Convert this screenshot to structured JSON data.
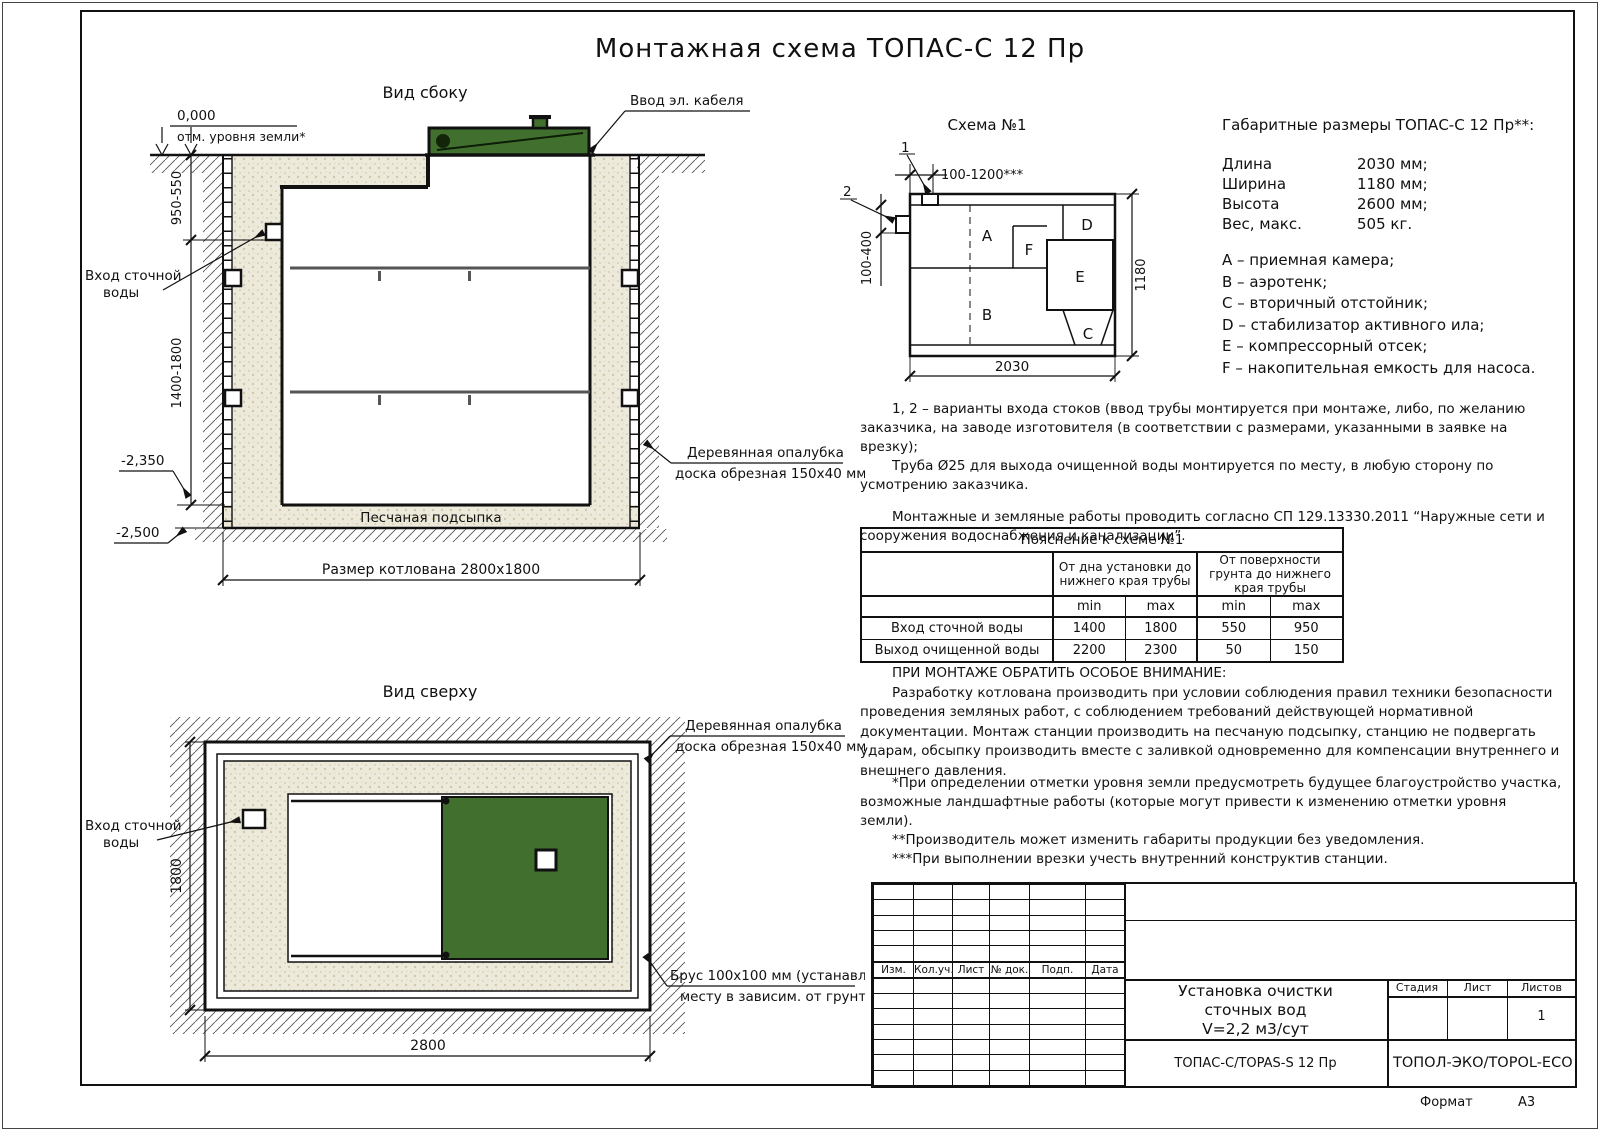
{
  "title": "Монтажная схема ТОПАС-С 12 Пр",
  "colors": {
    "lid_green": "#41702e",
    "sand": "#edeadb",
    "line": "#141414"
  },
  "side_view": {
    "label": "Вид сбоку",
    "zero_mark": "0,000",
    "ground_note": "отм. уровня земли*",
    "dim_upper": "950-550",
    "dim_lower": "1400-1800",
    "mark_sand_top": "-2,350",
    "mark_pit_floor": "-2,500",
    "inlet_label_1": "Вход сточной",
    "inlet_label_2": "воды",
    "cable_label": "Ввод эл. кабеля",
    "formwork_label_1": "Деревянная опалубка",
    "formwork_label_2": "доска обрезная 150x40 мм",
    "sand_label": "Песчаная подсыпка",
    "pit_dim": "Размер котлована 2800x1800"
  },
  "top_view": {
    "label": "Вид сверху",
    "inlet_label_1": "Вход сточной",
    "inlet_label_2": "воды",
    "dim_height": "1800",
    "dim_width": "2800",
    "formwork_label_1": "Деревянная опалубка",
    "formwork_label_2": "доска обрезная 150x40 мм",
    "beam_label_1": "Брус 100x100 мм (устанавл. по",
    "beam_label_2": "месту в зависим. от грунта)"
  },
  "schema": {
    "title": "Схема №1",
    "callout_1": "1",
    "callout_2": "2",
    "dim_top": "100-1200***",
    "dim_left": "100-400",
    "dim_right": "1180",
    "dim_bottom": "2030",
    "rooms": {
      "a": "A",
      "b": "B",
      "c": "C",
      "d": "D",
      "e": "E",
      "f": "F"
    }
  },
  "dimensions": {
    "header": "Габаритные размеры ТОПАС-С 12 Пр**:",
    "rows": [
      {
        "label": "Длина",
        "value": "2030 мм;"
      },
      {
        "label": "Ширина",
        "value": "1180 мм;"
      },
      {
        "label": "Высота",
        "value": "2600 мм;"
      },
      {
        "label": "Вес, макс.",
        "value": "505 кг."
      }
    ],
    "legend": [
      "A – приемная камера;",
      "B – аэротенк;",
      "C – вторичный отстойник;",
      "D – стабилизатор активного ила;",
      "E – компрессорный отсек;",
      "F – накопительная емкость для насоса."
    ]
  },
  "notes": {
    "variants_1": "1, 2 – варианты входа  стоков (ввод трубы монтируется при монтаже, либо, по желанию заказчика, на заводе изготовителя (в соответствии с размерами, указанными в заявке на врезку);",
    "variants_2": "Труба Ø25 для выхода очищенной воды монтируется по месту, в любую сторону по усмотрению заказчика.",
    "sp": "Монтажные и земляные работы проводить согласно СП 129.13330.2011 “Наружные сети и сооружения водоснабжения и канализации”."
  },
  "table": {
    "title": "Пояснение к схеме №1",
    "col_group_1": "От дна установки до нижнего края трубы",
    "col_group_2": "От поверхности грунта до нижнего края трубы",
    "min": "min",
    "max": "max",
    "rows": [
      {
        "label": "Вход сточной воды",
        "v1": "1400",
        "v2": "1800",
        "v3": "550",
        "v4": "950"
      },
      {
        "label": "Выход очищенной воды",
        "v1": "2200",
        "v2": "2300",
        "v3": "50",
        "v4": "150"
      }
    ]
  },
  "attention": {
    "header": "ПРИ МОНТАЖЕ ОБРАТИТЬ ОСОБОЕ ВНИМАНИЕ:",
    "body": "Разработку котлована производить при условии соблюдения правил техники безопасности проведения земляных работ, с соблюдением требований действующей нормативной документации. Монтаж станции производить на песчаную подсыпку, станцию не подвергать ударам, обсыпку производить вместе с заливкой одновременно для компенсации внутреннего и внешнего давления."
  },
  "footnotes": {
    "f1": "*При определении отметки уровня земли предусмотреть будущее благоустройство участка, возможные ландшафтные работы (которые могут привести к изменению отметки уровня земли).",
    "f2": "**Производитель может изменить габариты продукции без уведомления.",
    "f3": "***При выполнении врезки учесть внутренний конструктив станции.",
    "consumption": "Расход песка не менее – 7,9 м³, расход воды не менее – 3,2 м³."
  },
  "stamp": {
    "rev_headers": [
      "Изм.",
      "Кол.уч.",
      "Лист",
      "№ док.",
      "Подп.",
      "Дата"
    ],
    "title_1": "Установка очистки",
    "title_2": "сточных вод",
    "title_3": "V=2,2 м3/сут",
    "model": "ТОПАС-С/TOPAS-S 12 Пр",
    "stage_label": "Стадия",
    "sheet_label": "Лист",
    "sheets_label": "Листов",
    "sheets_value": "1",
    "company": "ТОПОЛ-ЭКО/TOPOL-ECO",
    "format_label": "Формат",
    "format_value": "А3"
  }
}
